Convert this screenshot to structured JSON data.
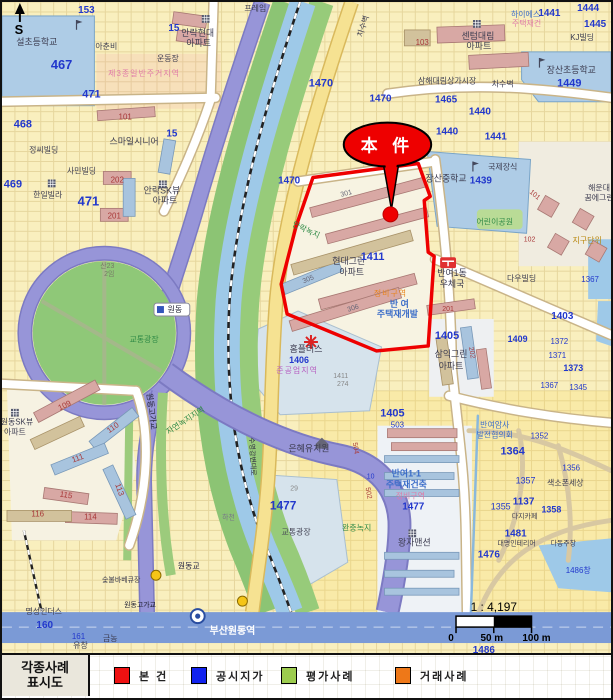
{
  "legend": {
    "title_line1": "각종사례",
    "title_line2": "표시도",
    "items": [
      {
        "label": "본 건",
        "color": "#ee1111"
      },
      {
        "label": "공시지가",
        "color": "#1122ee"
      },
      {
        "label": "평가사례",
        "color": "#9ccc4e"
      },
      {
        "label": "거래사례",
        "color": "#ee7818"
      }
    ]
  },
  "scale": {
    "ratio": "1 : 4,197",
    "ticks": [
      "0",
      "50 m",
      "100 m"
    ]
  },
  "callout": {
    "text": "本 件"
  },
  "compass": {
    "label": "S"
  },
  "station": {
    "name": "부산원동역"
  },
  "map": {
    "palette": {
      "blue": "#2238cc",
      "name": "#3c3c50",
      "red": "#a83838",
      "pink": "#e07ca8",
      "orange": "#e8851e",
      "bluetxt": "#3a6cc8",
      "green": "#2f8a46",
      "purple": "#b65cc0"
    },
    "labels": [
      {
        "t": "153",
        "x": 85,
        "y": 11,
        "c": "blue",
        "s": 10,
        "b": 1
      },
      {
        "t": "467",
        "x": 60,
        "y": 67,
        "c": "blue",
        "s": 13,
        "b": 1
      },
      {
        "t": "설초등학교",
        "x": 35,
        "y": 43,
        "c": "name",
        "s": 9
      },
      {
        "t": "아춘비",
        "x": 105,
        "y": 47,
        "c": "name",
        "s": 8
      },
      {
        "t": "15",
        "x": 173,
        "y": 29,
        "c": "blue",
        "s": 10,
        "b": 1
      },
      {
        "t": "운동장",
        "x": 167,
        "y": 59,
        "c": "name",
        "s": 8
      },
      {
        "t": "제3종일반주거지역",
        "x": 143,
        "y": 74,
        "c": "pink",
        "s": 8,
        "sp": 1
      },
      {
        "t": "101",
        "x": 124,
        "y": 118,
        "c": "red",
        "s": 8
      },
      {
        "t": "468",
        "x": 21,
        "y": 126,
        "c": "blue",
        "s": 11,
        "b": 1
      },
      {
        "t": "471",
        "x": 90,
        "y": 96,
        "c": "blue",
        "s": 11,
        "b": 1
      },
      {
        "t": "정씨빌딩",
        "x": 42,
        "y": 151,
        "c": "name",
        "s": 8
      },
      {
        "t": "15",
        "x": 171,
        "y": 135,
        "c": "blue",
        "s": 10,
        "b": 1
      },
      {
        "t": "스마일시니어",
        "x": 133,
        "y": 143,
        "c": "name",
        "s": 9
      },
      {
        "t": "사민빌딩",
        "x": 80,
        "y": 172,
        "c": "name",
        "s": 8
      },
      {
        "t": "469",
        "x": 11,
        "y": 186,
        "c": "blue",
        "s": 11,
        "b": 1
      },
      {
        "t": "한일빌라",
        "x": 46,
        "y": 196,
        "c": "name",
        "s": 8
      },
      {
        "t": "471",
        "x": 87,
        "y": 204,
        "c": "blue",
        "s": 13,
        "b": 1
      },
      {
        "t": "202",
        "x": 116,
        "y": 181,
        "c": "red",
        "s": 8
      },
      {
        "t": "201",
        "x": 113,
        "y": 217,
        "c": "red",
        "s": 8
      },
      {
        "t": "안락SK뷰",
        "x": 161,
        "y": 192,
        "c": "name",
        "s": 9
      },
      {
        "t": "아파트",
        "x": 164,
        "y": 202,
        "c": "name",
        "s": 9
      },
      {
        "t": "안락현대",
        "x": 197,
        "y": 34,
        "c": "name",
        "s": 9
      },
      {
        "t": "아파트",
        "x": 198,
        "y": 44,
        "c": "name",
        "s": 9
      },
      {
        "t": "프레임",
        "x": 255,
        "y": 9,
        "c": "name",
        "s": 8
      },
      {
        "t": "1470",
        "x": 321,
        "y": 85,
        "c": "blue",
        "s": 11,
        "b": 1
      },
      {
        "t": "1470",
        "x": 381,
        "y": 100,
        "c": "blue",
        "s": 10,
        "b": 1
      },
      {
        "t": "1470",
        "x": 289,
        "y": 182,
        "c": "blue",
        "s": 10,
        "b": 1
      },
      {
        "t": "차수벽",
        "x": 366,
        "y": 25,
        "c": "name",
        "s": 8,
        "r": -72
      },
      {
        "t": "하이에스",
        "x": 527,
        "y": 15,
        "c": "bluetxt",
        "s": 8
      },
      {
        "t": "1441",
        "x": 551,
        "y": 14,
        "c": "blue",
        "s": 10,
        "b": 1
      },
      {
        "t": "주택재건",
        "x": 528,
        "y": 24,
        "c": "pink",
        "s": 8
      },
      {
        "t": "1444",
        "x": 590,
        "y": 9,
        "c": "blue",
        "s": 10,
        "b": 1
      },
      {
        "t": "1445",
        "x": 597,
        "y": 25,
        "c": "blue",
        "s": 10,
        "b": 1
      },
      {
        "t": "KJ빌딩",
        "x": 584,
        "y": 38,
        "c": "name",
        "s": 8
      },
      {
        "t": "103",
        "x": 423,
        "y": 43,
        "c": "red",
        "s": 8
      },
      {
        "t": "센텀대림",
        "x": 479,
        "y": 37,
        "c": "name",
        "s": 9
      },
      {
        "t": "아파트",
        "x": 480,
        "y": 47,
        "c": "name",
        "s": 9
      },
      {
        "t": "장산초등학교",
        "x": 573,
        "y": 71,
        "c": "name",
        "s": 9
      },
      {
        "t": "1449",
        "x": 571,
        "y": 85,
        "c": "blue",
        "s": 11,
        "b": 1
      },
      {
        "t": "삼해대림상가시장",
        "x": 448,
        "y": 82,
        "c": "name",
        "s": 8
      },
      {
        "t": "차수벽",
        "x": 504,
        "y": 85,
        "c": "name",
        "s": 8
      },
      {
        "t": "1465",
        "x": 447,
        "y": 101,
        "c": "blue",
        "s": 10,
        "b": 1
      },
      {
        "t": "1440",
        "x": 481,
        "y": 113,
        "c": "blue",
        "s": 10,
        "b": 1
      },
      {
        "t": "1440",
        "x": 448,
        "y": 133,
        "c": "blue",
        "s": 10,
        "b": 1
      },
      {
        "t": "1441",
        "x": 497,
        "y": 138,
        "c": "blue",
        "s": 10,
        "b": 1
      },
      {
        "t": "국제장식",
        "x": 504,
        "y": 168,
        "c": "name",
        "s": 8
      },
      {
        "t": "장산중학교",
        "x": 447,
        "y": 180,
        "c": "name",
        "s": 9
      },
      {
        "t": "1439",
        "x": 482,
        "y": 182,
        "c": "blue",
        "s": 10,
        "b": 1
      },
      {
        "t": "해운대",
        "x": 601,
        "y": 189,
        "c": "name",
        "s": 8
      },
      {
        "t": "꿈에그린",
        "x": 601,
        "y": 199,
        "c": "name",
        "s": 8
      },
      {
        "t": "어린이공원",
        "x": 496,
        "y": 223,
        "c": "green",
        "s": 8
      },
      {
        "t": "101",
        "x": 535,
        "y": 195,
        "c": "red",
        "s": 7,
        "r": 40
      },
      {
        "t": "102",
        "x": 531,
        "y": 240,
        "c": "red",
        "s": 7
      },
      {
        "t": "지구단위",
        "x": 589,
        "y": 242,
        "c": "#b8860b",
        "s": 8
      },
      {
        "t": "안락녹지",
        "x": 305,
        "y": 231,
        "c": "green",
        "s": 8,
        "r": 25
      },
      {
        "t": "301",
        "x": 347,
        "y": 194,
        "c": "#666677",
        "s": 7,
        "r": -15
      },
      {
        "t": "현대그린",
        "x": 349,
        "y": 263,
        "c": "name",
        "s": 9
      },
      {
        "t": "1411",
        "x": 373,
        "y": 259,
        "c": "blue",
        "s": 11,
        "b": 1
      },
      {
        "t": "아파트",
        "x": 352,
        "y": 274,
        "c": "name",
        "s": 9
      },
      {
        "t": "305",
        "x": 309,
        "y": 280,
        "c": "#666677",
        "s": 7,
        "r": -22
      },
      {
        "t": "306",
        "x": 354,
        "y": 309,
        "c": "#666677",
        "s": 7,
        "r": -18
      },
      {
        "t": "정비구역",
        "x": 391,
        "y": 295,
        "c": "orange",
        "s": 8,
        "sp": 1
      },
      {
        "t": "반 여",
        "x": 400,
        "y": 306,
        "c": "bluetxt",
        "s": 9,
        "b": 1
      },
      {
        "t": "주택재개발",
        "x": 398,
        "y": 316,
        "c": "bluetxt",
        "s": 9,
        "b": 1
      },
      {
        "t": "반여1동",
        "x": 453,
        "y": 275,
        "c": "name",
        "s": 9
      },
      {
        "t": "우체국",
        "x": 453,
        "y": 286,
        "c": "name",
        "s": 9
      },
      {
        "t": "다우빌딩",
        "x": 523,
        "y": 280,
        "c": "name",
        "s": 8
      },
      {
        "t": "1367",
        "x": 592,
        "y": 281,
        "c": "blue",
        "s": 8
      },
      {
        "t": "1403",
        "x": 564,
        "y": 318,
        "c": "blue",
        "s": 10,
        "b": 1
      },
      {
        "t": "201",
        "x": 449,
        "y": 310,
        "c": "red",
        "s": 7
      },
      {
        "t": "1405",
        "x": 448,
        "y": 338,
        "c": "blue",
        "s": 11,
        "b": 1
      },
      {
        "t": "1409",
        "x": 519,
        "y": 341,
        "c": "blue",
        "s": 9,
        "b": 1
      },
      {
        "t": "1372",
        "x": 561,
        "y": 343,
        "c": "blue",
        "s": 8
      },
      {
        "t": "202",
        "x": 471,
        "y": 352,
        "c": "red",
        "s": 7,
        "r": 80
      },
      {
        "t": "1371",
        "x": 559,
        "y": 357,
        "c": "blue",
        "s": 8
      },
      {
        "t": "삼익그린",
        "x": 452,
        "y": 356,
        "c": "name",
        "s": 9
      },
      {
        "t": "1373",
        "x": 575,
        "y": 370,
        "c": "blue",
        "s": 9,
        "b": 1
      },
      {
        "t": "아파트",
        "x": 452,
        "y": 368,
        "c": "name",
        "s": 9
      },
      {
        "t": "1367",
        "x": 551,
        "y": 387,
        "c": "blue",
        "s": 8
      },
      {
        "t": "1345",
        "x": 580,
        "y": 389,
        "c": "blue",
        "s": 8
      },
      {
        "t": "홈플러스",
        "x": 306,
        "y": 351,
        "c": "name",
        "s": 9
      },
      {
        "t": "1406",
        "x": 299,
        "y": 362,
        "c": "blue",
        "s": 9,
        "b": 1
      },
      {
        "t": "준공업지역",
        "x": 297,
        "y": 372,
        "c": "purple",
        "s": 8,
        "sp": 1
      },
      {
        "t": "1411",
        "x": 341,
        "y": 377,
        "c": "#888888",
        "s": 7
      },
      {
        "t": "274",
        "x": 343,
        "y": 385,
        "c": "#888888",
        "s": 7
      },
      {
        "t": "교통광장",
        "x": 143,
        "y": 341,
        "c": "green",
        "s": 8
      },
      {
        "t": "산23",
        "x": 106,
        "y": 267,
        "c": "#777766",
        "s": 7
      },
      {
        "t": "2임",
        "x": 108,
        "y": 275,
        "c": "#777766",
        "s": 7
      },
      {
        "t": "원동",
        "x": 174,
        "y": 311,
        "c": "#222233",
        "s": 8
      },
      {
        "t": "원동고가교",
        "x": 148,
        "y": 411,
        "c": "#222233",
        "s": 8,
        "r": 83
      },
      {
        "t": "자연녹지지역",
        "x": 186,
        "y": 422,
        "c": "green",
        "s": 8,
        "r": -33
      },
      {
        "t": "1477",
        "x": 283,
        "y": 509,
        "c": "blue",
        "s": 12,
        "b": 1
      },
      {
        "t": "29",
        "x": 294,
        "y": 490,
        "c": "#888888",
        "s": 7
      },
      {
        "t": "교통광장",
        "x": 296,
        "y": 534,
        "c": "#444455",
        "s": 8
      },
      {
        "t": "하천",
        "x": 228,
        "y": 519,
        "c": "#777788",
        "s": 7
      },
      {
        "t": "수영강변대로",
        "x": 250,
        "y": 456,
        "c": "#333344",
        "s": 7,
        "r": 87
      },
      {
        "t": "은혜유치원",
        "x": 309,
        "y": 451,
        "c": "name",
        "s": 9
      },
      {
        "t": "1405",
        "x": 393,
        "y": 416,
        "c": "blue",
        "s": 11,
        "b": 1
      },
      {
        "t": "503",
        "x": 398,
        "y": 427,
        "c": "blue",
        "s": 8
      },
      {
        "t": "504",
        "x": 354,
        "y": 448,
        "c": "red",
        "s": 7,
        "r": 80
      },
      {
        "t": "10",
        "x": 371,
        "y": 478,
        "c": "blue",
        "s": 7
      },
      {
        "t": "502",
        "x": 367,
        "y": 493,
        "c": "red",
        "s": 7,
        "r": 80
      },
      {
        "t": "반여암사",
        "x": 496,
        "y": 427,
        "c": "bluetxt",
        "s": 8
      },
      {
        "t": "발전협의회",
        "x": 496,
        "y": 437,
        "c": "bluetxt",
        "s": 8
      },
      {
        "t": "1364",
        "x": 514,
        "y": 454,
        "c": "blue",
        "s": 11,
        "b": 1
      },
      {
        "t": "1352",
        "x": 541,
        "y": 438,
        "c": "blue",
        "s": 8
      },
      {
        "t": "1356",
        "x": 573,
        "y": 470,
        "c": "blue",
        "s": 8
      },
      {
        "t": "1357",
        "x": 527,
        "y": 483,
        "c": "blue",
        "s": 9
      },
      {
        "t": "색소폰세상",
        "x": 567,
        "y": 485,
        "c": "name",
        "s": 8
      },
      {
        "t": "반여1-1",
        "x": 407,
        "y": 476,
        "c": "bluetxt",
        "s": 9,
        "b": 1
      },
      {
        "t": "주택재건축",
        "x": 407,
        "y": 487,
        "c": "bluetxt",
        "s": 9,
        "b": 1
      },
      {
        "t": "정비구역",
        "x": 411,
        "y": 498,
        "c": "pink",
        "s": 8
      },
      {
        "t": "1477",
        "x": 414,
        "y": 509,
        "c": "blue",
        "s": 10,
        "b": 1
      },
      {
        "t": "1137",
        "x": 525,
        "y": 504,
        "c": "blue",
        "s": 10,
        "b": 1
      },
      {
        "t": "1355",
        "x": 502,
        "y": 509,
        "c": "blue",
        "s": 9
      },
      {
        "t": "1358",
        "x": 553,
        "y": 512,
        "c": "blue",
        "s": 9,
        "b": 1
      },
      {
        "t": "다지카페",
        "x": 526,
        "y": 518,
        "c": "name",
        "s": 7
      },
      {
        "t": "완충녹지",
        "x": 357,
        "y": 530,
        "c": "green",
        "s": 8
      },
      {
        "t": "1481",
        "x": 517,
        "y": 536,
        "c": "blue",
        "s": 10,
        "b": 1
      },
      {
        "t": "대명인테리어",
        "x": 518,
        "y": 545,
        "c": "name",
        "s": 7
      },
      {
        "t": "다동주창",
        "x": 565,
        "y": 545,
        "c": "name",
        "s": 7
      },
      {
        "t": "왕자맨션",
        "x": 415,
        "y": 545,
        "c": "name",
        "s": 9
      },
      {
        "t": "1476",
        "x": 490,
        "y": 557,
        "c": "blue",
        "s": 10,
        "b": 1
      },
      {
        "t": "1486창",
        "x": 580,
        "y": 573,
        "c": "blue",
        "s": 8
      },
      {
        "t": "109",
        "x": 64,
        "y": 407,
        "c": "red",
        "s": 8,
        "r": -25
      },
      {
        "t": "110",
        "x": 113,
        "y": 429,
        "c": "red",
        "s": 8,
        "r": -35
      },
      {
        "t": "원동SK뷰",
        "x": 15,
        "y": 424,
        "c": "name",
        "s": 8
      },
      {
        "t": "아파트",
        "x": 13,
        "y": 434,
        "c": "name",
        "s": 8
      },
      {
        "t": "111",
        "x": 77,
        "y": 460,
        "c": "red",
        "s": 8,
        "r": -20
      },
      {
        "t": "113",
        "x": 116,
        "y": 490,
        "c": "red",
        "s": 8,
        "r": 70
      },
      {
        "t": "115",
        "x": 64,
        "y": 497,
        "c": "red",
        "s": 8,
        "r": 10
      },
      {
        "t": "116",
        "x": 36,
        "y": 516,
        "c": "red",
        "s": 8
      },
      {
        "t": "114",
        "x": 89,
        "y": 519,
        "c": "red",
        "s": 8
      },
      {
        "t": "명성인더스",
        "x": 42,
        "y": 614,
        "c": "name",
        "s": 8
      },
      {
        "t": "160",
        "x": 43,
        "y": 628,
        "c": "blue",
        "s": 10,
        "b": 1
      },
      {
        "t": "161",
        "x": 77,
        "y": 639,
        "c": "blue",
        "s": 8
      },
      {
        "t": "유창",
        "x": 79,
        "y": 648,
        "c": "name",
        "s": 8
      },
      {
        "t": "금농",
        "x": 109,
        "y": 641,
        "c": "name",
        "s": 8
      },
      {
        "t": "숯불바베큐장",
        "x": 120,
        "y": 582,
        "c": "name",
        "s": 7
      },
      {
        "t": "원동교",
        "x": 188,
        "y": 568,
        "c": "#222244",
        "s": 8
      },
      {
        "t": "원동고가교",
        "x": 139,
        "y": 607,
        "c": "#222233",
        "s": 7
      },
      {
        "t": "1486",
        "x": 485,
        "y": 653,
        "c": "blue",
        "s": 10,
        "b": 1
      }
    ]
  }
}
